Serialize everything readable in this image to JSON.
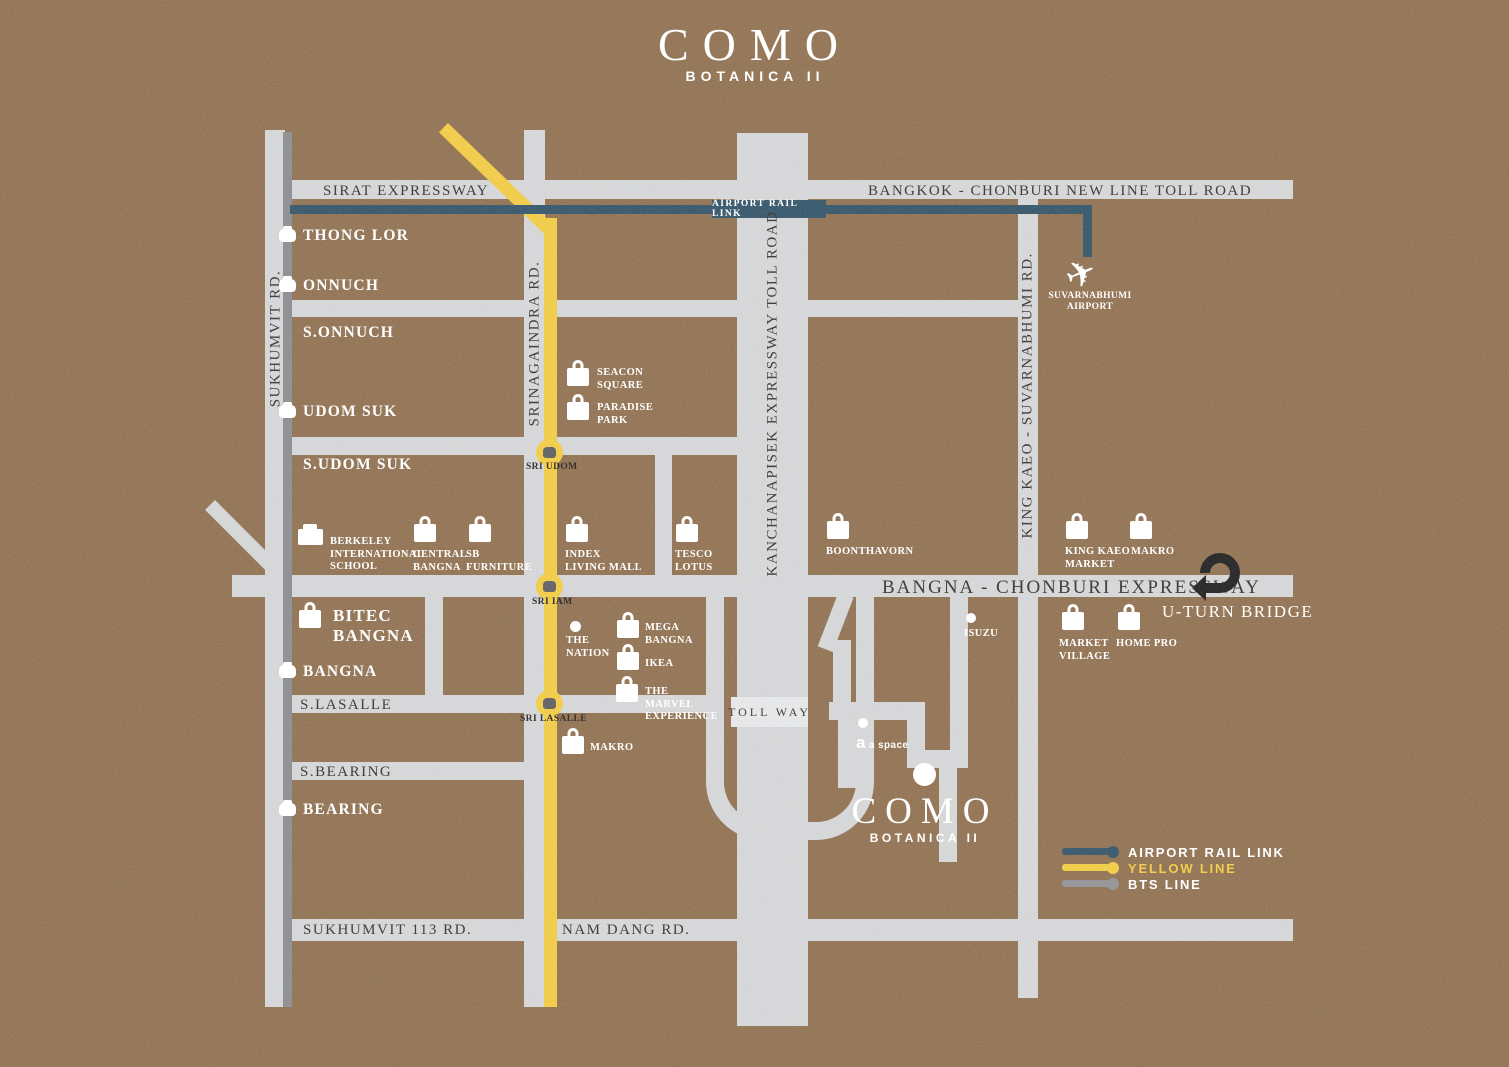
{
  "header": {
    "title": "COMO",
    "subtitle": "BOTANICA II"
  },
  "project_marker": {
    "title": "COMO",
    "subtitle": "BOTANICA II"
  },
  "rails": {
    "airport_rail_link_badge": "AIRPORT RAIL LINK"
  },
  "roads": {
    "sirat_expressway": "SIRAT EXPRESSWAY",
    "bangkok_chonburi_toll": "BANGKOK - CHONBURI NEW LINE TOLL ROAD",
    "bangna_chonburi_expressway": "BANGNA - CHONBURI EXPRESSWAY",
    "sukhumvit_rd": "SUKHUMVIT RD.",
    "srinagaindra_rd": "SRINAGAINDRA RD.",
    "kanchanapisek": "KANCHANAPISEK EXPRESSWAY TOLL ROAD",
    "king_kaeo_rd": "KING KAEO - SUVARNABHUMI RD.",
    "sukhumvit_113_rd": "SUKHUMVIT 113 RD.",
    "nam_dang_rd": "NAM DANG RD.",
    "s_lasalle": "S.LASALLE",
    "s_bearing": "S.BEARING",
    "toll_way": "TOLL WAY",
    "u_turn_bridge": "U-TURN BRIDGE"
  },
  "bts_stations": [
    {
      "label": "THONG LOR"
    },
    {
      "label": "ONNUCH"
    },
    {
      "label": "UDOM SUK"
    },
    {
      "label": "BANGNA"
    },
    {
      "label": "BEARING"
    }
  ],
  "soi_labels": [
    {
      "label": "S.ONNUCH"
    },
    {
      "label": "S.UDOM SUK"
    }
  ],
  "yellow_stations": [
    {
      "label": "SRI UDOM"
    },
    {
      "label": "SRI IAM"
    },
    {
      "label": "SRI LASALLE"
    }
  ],
  "bitec": {
    "label": "BITEC\nBANGNA"
  },
  "landmarks": [
    {
      "label": "SEACON\nSQUARE",
      "icon": "bag-icon"
    },
    {
      "label": "PARADISE\nPARK",
      "icon": "bag-icon"
    },
    {
      "label": "BERKELEY\nINTERNATIONAL\nSCHOOL",
      "icon": "school-icon"
    },
    {
      "label": "CENTRAL\nBANGNA",
      "icon": "bag-icon"
    },
    {
      "label": "SB\nFURNITURE",
      "icon": "bag-icon"
    },
    {
      "label": "INDEX\nLIVING MALL",
      "icon": "bag-icon"
    },
    {
      "label": "TESCO\nLOTUS",
      "icon": "bag-icon"
    },
    {
      "label": "BOONTHAVORN",
      "icon": "bag-icon"
    },
    {
      "label": "KING KAEO\nMARKET",
      "icon": "bag-icon"
    },
    {
      "label": "MAKRO",
      "icon": "bag-icon"
    },
    {
      "label": "MARKET\nVILLAGE",
      "icon": "bag-icon"
    },
    {
      "label": "HOME PRO",
      "icon": "bag-icon"
    },
    {
      "label": "MEGA\nBANGNA",
      "icon": "bag-icon"
    },
    {
      "label": "IKEA",
      "icon": "bag-icon"
    },
    {
      "label": "THE\nMARVEL\nEXPERIENCE",
      "icon": "bag-icon"
    },
    {
      "label": "MAKRO",
      "icon": "bag-icon"
    },
    {
      "label": "THE\nNATION",
      "icon": "dot-icon"
    },
    {
      "label": "ISUZU",
      "icon": "dot-icon"
    },
    {
      "label": "a space",
      "icon": "dot-icon"
    }
  ],
  "airport": {
    "label": "SUVARNABHUMI\nAIRPORT",
    "icon": "plane-icon"
  },
  "legend": {
    "items": [
      {
        "label": "AIRPORT RAIL LINK",
        "color": "#2b4d63"
      },
      {
        "label": "YELLOW LINE",
        "color": "#f0c83c"
      },
      {
        "label": "BTS LINE",
        "color": "#8b8d90"
      }
    ]
  },
  "colors": {
    "background": "#8b6a49",
    "road": "#d2d3d5",
    "bts_line": "#85878a",
    "yellow_line": "#f0c83c",
    "airport_rail_link": "#2b4d63",
    "label_dark": "#2f2a26",
    "label_light": "#ffffff"
  }
}
